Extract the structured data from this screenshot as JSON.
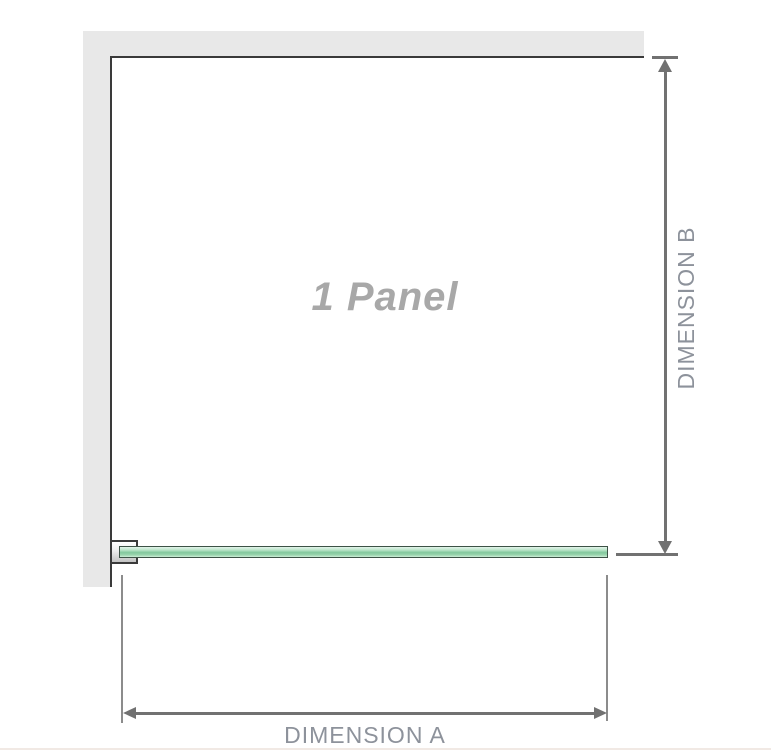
{
  "diagram": {
    "panel_label": "1 Panel",
    "dimension_a_label": "DIMENSION A",
    "dimension_b_label": "DIMENSION B"
  },
  "icons": {
    "dimension_b_arrows": "double-headed-vertical-arrow",
    "dimension_a_arrows": "double-headed-horizontal-arrow"
  },
  "colors": {
    "wall": "#e8e8e8",
    "outline": "#3a3a3a",
    "dim_line": "#717171",
    "ext_line": "#8c8c8c",
    "label_text": "#8d929b",
    "panel_label_text": "#a8a8a8",
    "glass_fill": "#9bd5ae",
    "glass_fill_dark": "#82c89d",
    "glass_border": "#3d5246",
    "bottom_divider": "#f1e9e4"
  }
}
